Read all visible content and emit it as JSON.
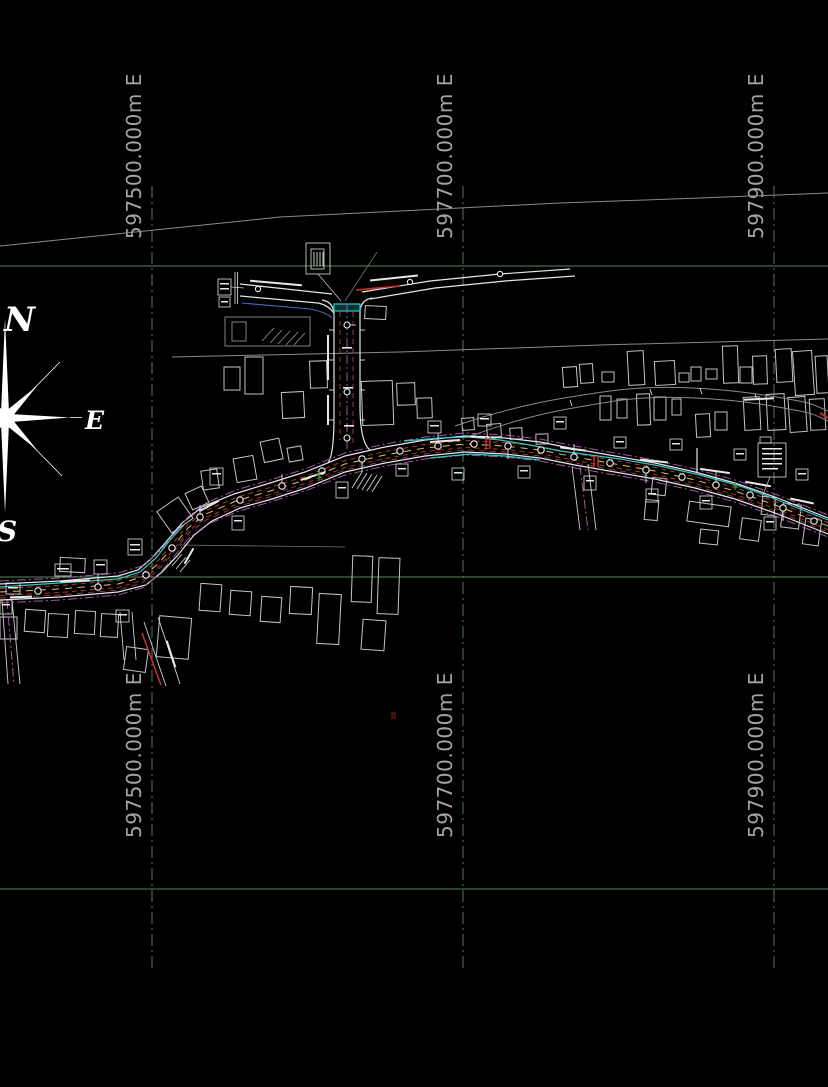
{
  "canvas": {
    "background": "#000000",
    "width": 828,
    "height": 1087,
    "type": "cad-survey-plan"
  },
  "grid": {
    "line_color_vertical": "#4e7e50",
    "line_color_horizontal": "#57875a",
    "label_color": "#a3a3a3",
    "eastings": [
      {
        "label": "597500.000m E"
      },
      {
        "label": "597700.000m E"
      },
      {
        "label": "597900.000m E"
      }
    ]
  },
  "compass": {
    "north": "N",
    "east": "E",
    "south": "S"
  },
  "layers": {
    "road_edge": "#e6e6e6",
    "centerline_yellow": "#d8c84e",
    "utility_red": "#b03030",
    "utility_cyan": "#2cc8c8",
    "utility_blue": "#3f6fc0",
    "utility_magenta": "#a855a8",
    "building_outline": "#c4c4c4",
    "boundary_line": "#8a8a8a"
  }
}
